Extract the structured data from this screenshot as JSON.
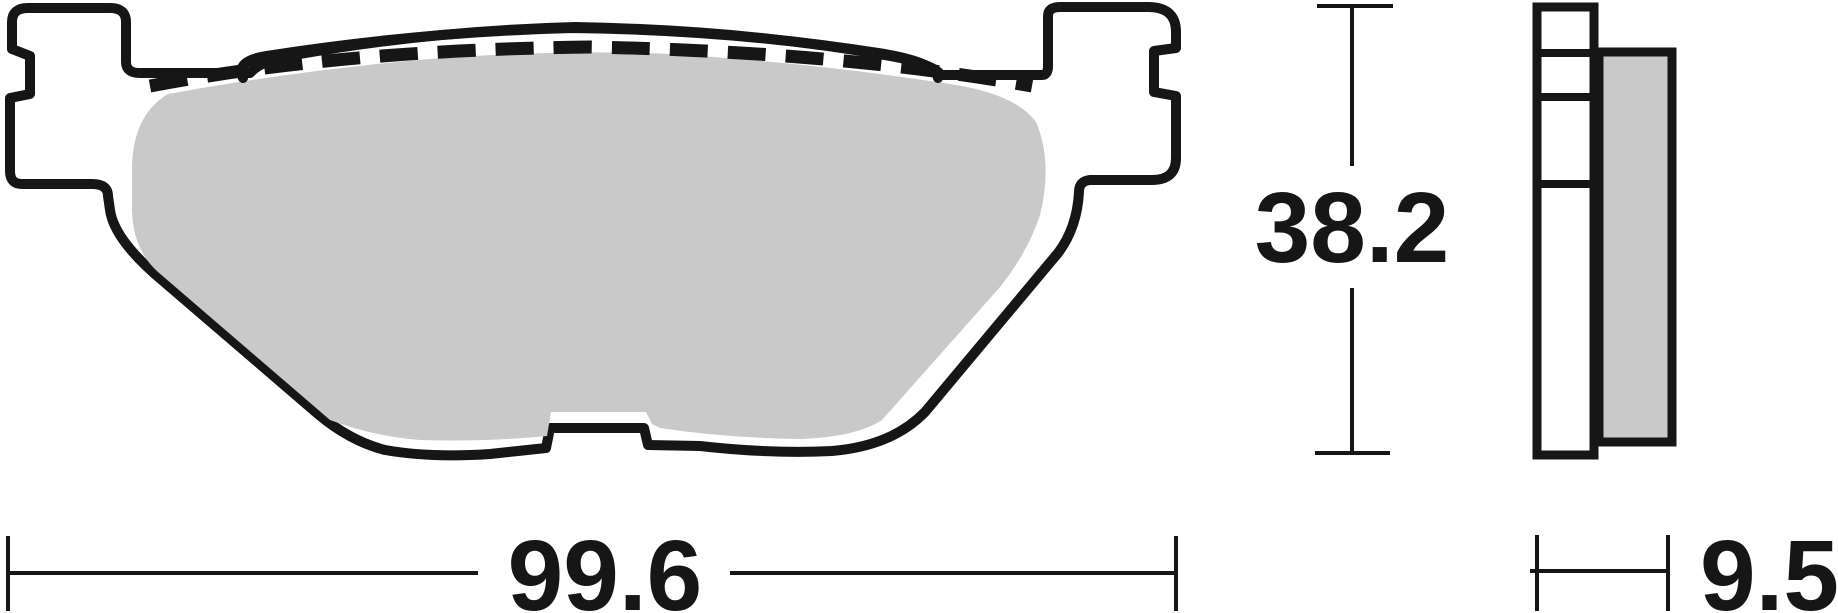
{
  "dimensions": {
    "width": {
      "value": "99.6"
    },
    "height": {
      "value": "38.2"
    },
    "thickness": {
      "value": "9.5"
    }
  },
  "colors": {
    "line": "#161616",
    "friction_fill": "#c9c9c9",
    "background": "#ffffff"
  }
}
